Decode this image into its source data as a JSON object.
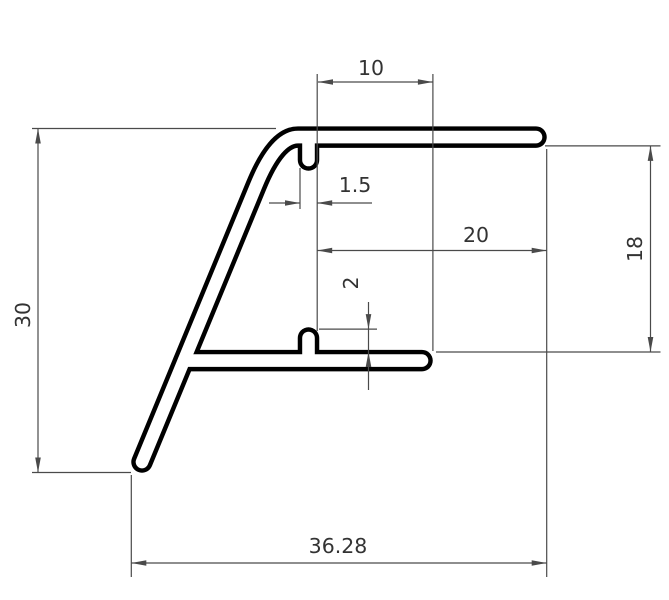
{
  "drawing": {
    "description": "Technical dimensioned drawing of an aluminium extrusion profile cross-section",
    "canvas": {
      "width": 669,
      "height": 600,
      "background": "#ffffff"
    },
    "colors": {
      "profile_outline": "#000000",
      "profile_interior": "#ffffff",
      "dimension_line": "#4a4a4a",
      "dimension_text": "#333333"
    },
    "style": {
      "outline_outer_stroke": 21.5,
      "outline_inner_stroke": 12.6,
      "dim_line_width": 1.2,
      "font_size": 20.5,
      "arrow_length": 15,
      "arrow_half_width": 2.8
    },
    "profile": {
      "wall_thickness_mm": 1.5,
      "scale_px_per_mm": 11.47,
      "centerline_paths": [
        {
          "name": "leg-and-top-flange",
          "d": "M 142 462 L 256 186 Q 276 137.1 298 137.1 L 536 137.1"
        },
        {
          "name": "lower-flange",
          "d": "M 184 360.6 L 422 360.6"
        },
        {
          "name": "top-gasket-fin",
          "d": "M 308.5 139 L 308.5 160"
        },
        {
          "name": "bottom-gasket-fin",
          "d": "M 308.5 358 L 308.5 338"
        }
      ]
    },
    "dimensions": [
      {
        "name": "dim-10",
        "label": "10",
        "value_mm": 10,
        "orientation": "horizontal",
        "label_x": 371,
        "label_y": 69,
        "rotated": false,
        "lines": [
          [
            318,
            82,
            432.9,
            82
          ],
          [
            317.2,
            74,
            317.2,
            331
          ],
          [
            432.9,
            74,
            432.9,
            351
          ]
        ],
        "arrows": [
          [
            318,
            82,
            180
          ],
          [
            432.9,
            82,
            0
          ]
        ]
      },
      {
        "name": "dim-1.5",
        "label": "1.5",
        "value_mm": 1.5,
        "orientation": "horizontal",
        "label_x": 355,
        "label_y": 186,
        "rotated": false,
        "lines": [
          [
            269,
            203,
            300,
            203
          ],
          [
            317.2,
            203,
            372,
            203
          ],
          [
            300,
            168,
            300,
            209
          ]
        ],
        "arrows": [
          [
            300,
            203,
            0
          ],
          [
            317.2,
            203,
            180
          ]
        ]
      },
      {
        "name": "dim-20",
        "label": "20",
        "value_mm": 20,
        "orientation": "horizontal",
        "label_x": 476,
        "label_y": 236,
        "rotated": false,
        "lines": [
          [
            317.2,
            250.5,
            546.7,
            250.5
          ],
          [
            546.7,
            149,
            546.7,
            577
          ]
        ],
        "arrows": [
          [
            317.2,
            250.5,
            180
          ],
          [
            546.7,
            250.5,
            0
          ]
        ]
      },
      {
        "name": "dim-18",
        "label": "18",
        "value_mm": 18,
        "orientation": "vertical",
        "label_x": 636,
        "label_y": 249,
        "rotated": true,
        "lines": [
          [
            650.5,
            145.9,
            650.5,
            352
          ],
          [
            545,
            145.9,
            660.5,
            145.9
          ],
          [
            436,
            352,
            660.5,
            352
          ]
        ],
        "arrows": [
          [
            650.5,
            145.9,
            -90
          ],
          [
            650.5,
            352,
            90
          ]
        ]
      },
      {
        "name": "dim-30",
        "label": "30",
        "value_mm": 30,
        "orientation": "vertical",
        "label_x": 24,
        "label_y": 315,
        "rotated": true,
        "lines": [
          [
            38,
            128.5,
            38,
            472.5
          ],
          [
            32,
            128.5,
            276,
            128.5
          ],
          [
            32,
            472.5,
            131,
            472.5
          ]
        ],
        "arrows": [
          [
            38,
            128.5,
            -90
          ],
          [
            38,
            472.5,
            90
          ]
        ]
      },
      {
        "name": "dim-2",
        "label": "2",
        "value_mm": 2,
        "orientation": "vertical",
        "label_x": 352,
        "label_y": 283,
        "rotated": true,
        "lines": [
          [
            368.5,
            302,
            368.5,
            390
          ],
          [
            319,
            329.1,
            377,
            329.1
          ]
        ],
        "arrows": [
          [
            368.5,
            329.1,
            90
          ],
          [
            368.5,
            352,
            -90
          ]
        ]
      },
      {
        "name": "dim-36.28",
        "label": "36.28",
        "value_mm": 36.28,
        "orientation": "horizontal",
        "label_x": 338,
        "label_y": 547,
        "rotated": false,
        "lines": [
          [
            131.3,
            563,
            546.7,
            563
          ],
          [
            131.3,
            475,
            131.3,
            577
          ]
        ],
        "arrows": [
          [
            131.3,
            563,
            180
          ],
          [
            546.7,
            563,
            0
          ]
        ]
      }
    ]
  }
}
